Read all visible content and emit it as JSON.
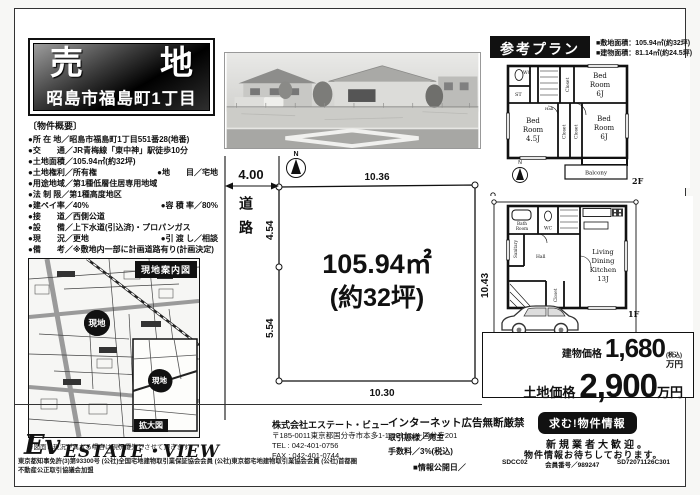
{
  "title": {
    "char1": "売",
    "char2": "地",
    "address": "昭島市福島町1丁目"
  },
  "overview": {
    "heading": "〔物件概要〕",
    "bullet": "●",
    "rows": [
      {
        "l1": "所 在 地／",
        "v1": "昭島市福島町1丁目551番28(地番)"
      },
      {
        "l1": "交　　通／",
        "v1": "JR青梅線「東中神」駅徒歩10分"
      },
      {
        "l1": "土地面積／",
        "v1": "105.94㎡(約32坪)"
      },
      {
        "l1": "土地権利／",
        "v1": "所有権",
        "l2": "地　　目／",
        "v2": "宅地"
      },
      {
        "l1": "用途地域／",
        "v1": "第1種低層住居専用地域"
      },
      {
        "l1": "法 制 限／",
        "v1": "第1種高度地区"
      },
      {
        "l1": "建ペイ率／",
        "v1": "40%",
        "l2": "容 積 率／",
        "v2": "80%"
      },
      {
        "l1": "接　　道／",
        "v1": "西側公道"
      },
      {
        "l1": "設　　備／",
        "v1": "上下水道(引込済)・プロパンガス"
      },
      {
        "l1": "現　　況／",
        "v1": "更地",
        "l2": "引 渡 し／",
        "v2": "相談"
      },
      {
        "l1": "備　　考／",
        "v1": "※敷地内一部に計画道路有り(計画決定)"
      }
    ]
  },
  "map": {
    "header": "現地案内図",
    "site_label": "現地",
    "inset_label": "拡大図",
    "note": "※図面と現況が異なる場合は現況優先とさせて頂きます。"
  },
  "plot": {
    "north": "N",
    "road": "道路",
    "road_width": "4.00",
    "dim_top": "10.36",
    "dim_left_upper": "4.54",
    "dim_left_lower": "5.54",
    "dim_right": "10.43",
    "dim_bottom": "10.30",
    "area_line1": "105.94㎡",
    "area_line2": "(約32坪)"
  },
  "plan": {
    "header": "参考プラン",
    "site_area": "■敷地面積：105.94㎡(約32坪)",
    "building_area": "■建物面積：81.14㎡(約24.5坪)",
    "f2": {
      "wc": "WC",
      "st": "ST",
      "closet": "Closet",
      "bed_a": "Bed",
      "bed_b": "Room",
      "bed1_size": "6J",
      "bed2_size": "4.5J",
      "bed3_size": "6J",
      "hall": "Hall",
      "balcony": "Balcony",
      "label": "2F",
      "north": "N"
    },
    "f1": {
      "bath_a": "Bath",
      "bath_b": "Room",
      "wc": "WC",
      "sanitary": "Sanitary",
      "hall": "Hall",
      "closet": "Closet",
      "ldk1": "Living",
      "ldk2": "Dining",
      "ldk3": "Kitchen",
      "ldk4": "13J",
      "label": "1F"
    }
  },
  "prices": {
    "building_label": "建物価格",
    "building_value": "1,680",
    "building_tax": "(税込)",
    "building_unit": "万円",
    "land_label": "土地価格",
    "land_value": "2,900",
    "land_unit": "万円"
  },
  "footer": {
    "logo": "Ev",
    "brand": "ESTATE・VIEW",
    "company": "株式会社エステート・ビュー",
    "address": "〒185-0011東京都国分寺市本多1-1-20ビュー国分寺201",
    "tel": "TEL : 042-401-0756",
    "fax": "FAX : 042-401-0744",
    "license": "東京都知事免許(3)第93300号 (公社)全国宅地建物取引業保証協会会員 (公社)東京都宅地建物取引業協会会員 (公社)首都圏不動産公正取引協議会加盟",
    "no_copy": "インターネット広告無断厳禁",
    "deal_type": "取引態様／売主",
    "fee": "手数料／3%(税込)",
    "info_date": "■情報公開日／",
    "seek": "求む!物件情報",
    "welcome1": "新規業者大歓迎。",
    "welcome2": "物件情報お待ちしております。",
    "code1": "SDCC02",
    "member": "会員番号／989247",
    "code2": "SD72071126C301"
  }
}
